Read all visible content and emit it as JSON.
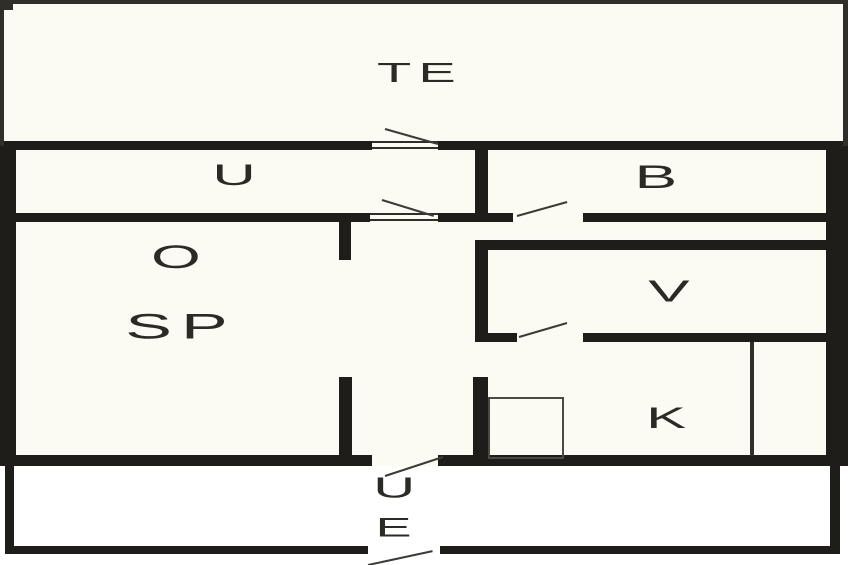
{
  "page": {
    "title": "Apartment floor plan"
  },
  "colors": {
    "paper": "#fbfaf3",
    "exterior": "#ffffff",
    "wall": "#1e1d1a",
    "thin_line": "#2f2e29",
    "swing_line": "#3c3b35",
    "label": "#2b2a25"
  },
  "floorplan": {
    "labels": [
      {
        "id": "room-label-te",
        "text": "TE",
        "x": 420,
        "y": 73,
        "size": 28
      },
      {
        "id": "room-label-u-hall",
        "text": "U",
        "x": 238,
        "y": 176,
        "size": 30
      },
      {
        "id": "room-label-b",
        "text": "B",
        "x": 660,
        "y": 177,
        "size": 32
      },
      {
        "id": "room-label-o",
        "text": "O",
        "x": 180,
        "y": 257,
        "size": 32
      },
      {
        "id": "room-label-sp",
        "text": "SP",
        "x": 181,
        "y": 327,
        "size": 35
      },
      {
        "id": "room-label-v",
        "text": "V",
        "x": 673,
        "y": 291,
        "size": 31
      },
      {
        "id": "room-label-k",
        "text": "K",
        "x": 670,
        "y": 419,
        "size": 30
      },
      {
        "id": "entry-label-u",
        "text": "U",
        "x": 398,
        "y": 489,
        "size": 29
      },
      {
        "id": "entry-label-e",
        "text": "E",
        "x": 397,
        "y": 528,
        "size": 27
      }
    ],
    "walls_thick": [
      [
        0,
        141,
        372,
        9
      ],
      [
        438,
        141,
        410,
        9
      ],
      [
        0,
        143,
        16,
        323
      ],
      [
        826,
        141,
        22,
        325
      ],
      [
        0,
        213,
        370,
        9
      ],
      [
        438,
        213,
        75,
        9
      ],
      [
        583,
        213,
        265,
        9
      ],
      [
        475,
        143,
        13,
        79
      ],
      [
        475,
        240,
        373,
        10
      ],
      [
        475,
        240,
        13,
        101
      ],
      [
        475,
        333,
        42,
        9
      ],
      [
        583,
        333,
        265,
        9
      ],
      [
        473,
        377,
        15,
        80
      ],
      [
        339,
        217,
        12,
        43
      ],
      [
        339,
        377,
        13,
        80
      ],
      [
        0,
        455,
        372,
        11
      ],
      [
        438,
        455,
        410,
        11
      ],
      [
        5,
        466,
        9,
        88
      ],
      [
        830,
        466,
        10,
        88
      ],
      [
        5,
        546,
        363,
        8
      ],
      [
        440,
        546,
        400,
        8
      ]
    ],
    "walls_thin": [
      [
        0,
        0,
        848,
        4
      ],
      [
        0,
        0,
        4,
        146
      ],
      [
        843,
        0,
        5,
        146
      ],
      [
        0,
        0,
        13,
        10
      ],
      [
        750,
        342,
        4,
        114
      ],
      [
        372,
        141,
        66,
        2
      ],
      [
        372,
        147,
        66,
        2
      ],
      [
        370,
        213,
        68,
        2
      ],
      [
        370,
        219,
        68,
        2
      ]
    ],
    "door_swings": [
      [
        385,
        129,
        438,
        144
      ],
      [
        382,
        200,
        434,
        216
      ],
      [
        517,
        216,
        567,
        202
      ],
      [
        519,
        337,
        567,
        323
      ],
      [
        385,
        476,
        443,
        457
      ],
      [
        368,
        565,
        433,
        551
      ]
    ],
    "fixture_box": [
      488,
      397,
      72,
      58
    ]
  }
}
